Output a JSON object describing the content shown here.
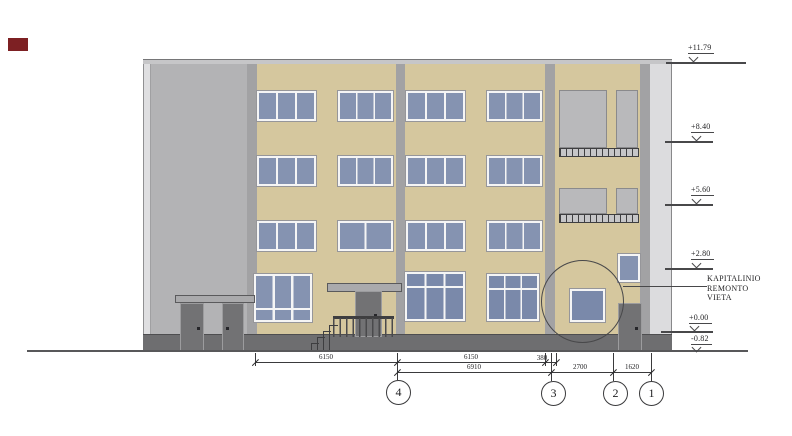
{
  "levels": {
    "v1": "+11.79",
    "v2": "+8.40",
    "v3": "+5.60",
    "v4": "+2.80",
    "v5": "+0.00",
    "v6": "-0.82"
  },
  "note": {
    "line1": "KAPITALINIO",
    "line2": "REMONTO",
    "line3": "VIETA"
  },
  "dims": {
    "row1": {
      "a": "6150",
      "b": "6150",
      "c": "380"
    },
    "row2": {
      "a": "6910",
      "b": "2700",
      "c": "1620"
    }
  },
  "axes": {
    "a4": "4",
    "a3": "3",
    "a2": "2",
    "a1": "1"
  },
  "colors": {
    "facade_tan": "#d5c79e",
    "stair_block": "#b3b3b5",
    "pilaster": "#a2a2a4",
    "end_strip": "#dcdcde",
    "glass_upper": "#8593b1",
    "glass_ground": "#7a89aa",
    "plinth": "#6e6e70",
    "balcony_panel": "#b9b9bb",
    "door": "#727274",
    "annotation_line": "#3a3a3c",
    "red_mark": "#7d2023"
  }
}
